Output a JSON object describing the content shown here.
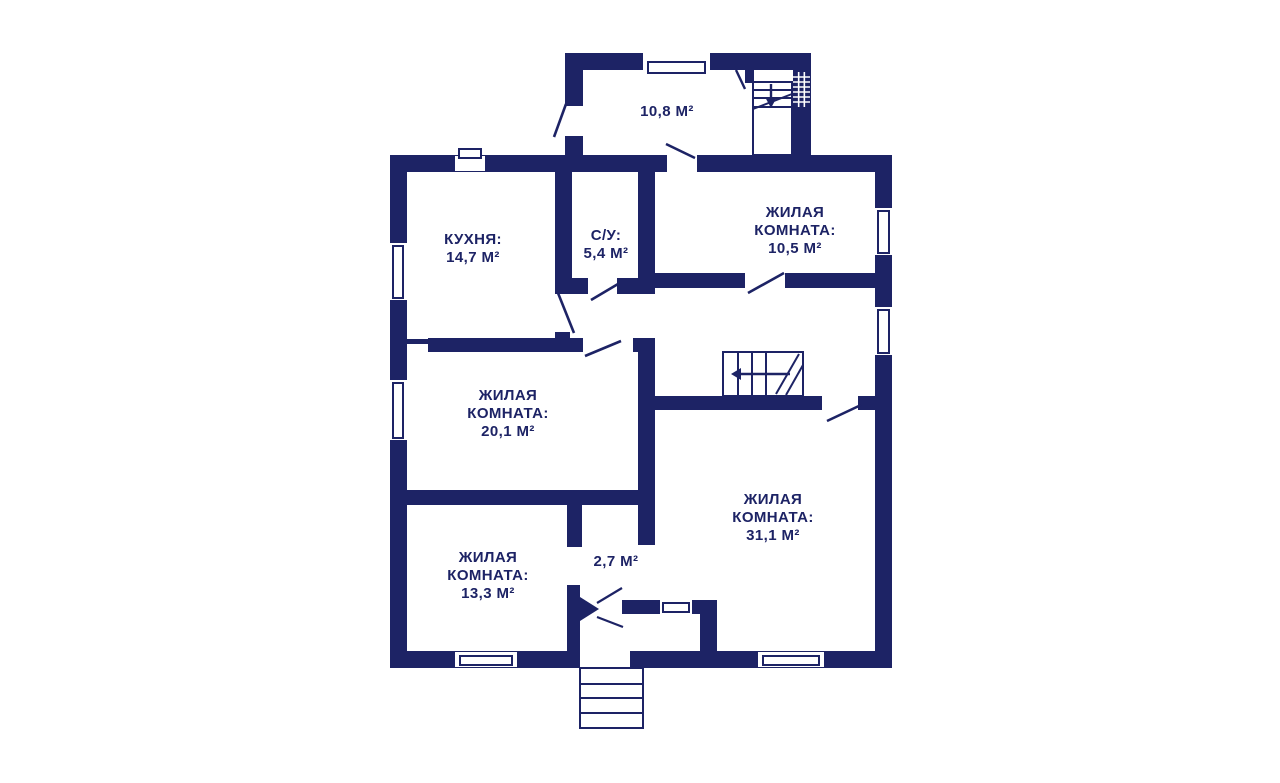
{
  "meta": {
    "type": "floor-plan",
    "wall_color": "#1d2365",
    "background_color": "#ffffff"
  },
  "labels": {
    "annex": {
      "l1": "10,8 М²"
    },
    "kitchen": {
      "l1": "КУХНЯ:",
      "l2": "14,7 М²"
    },
    "bathroom": {
      "l1": "С/У:",
      "l2": "5,4 М²"
    },
    "living_top": {
      "l1": "ЖИЛАЯ",
      "l2": "КОМНАТА:",
      "l3": "10,5 М²"
    },
    "living_mid": {
      "l1": "ЖИЛАЯ",
      "l2": "КОМНАТА:",
      "l3": "20,1 М²"
    },
    "living_big": {
      "l1": "ЖИЛАЯ",
      "l2": "КОМНАТА:",
      "l3": "31,1 М²"
    },
    "living_bottom": {
      "l1": "ЖИЛАЯ",
      "l2": "КОМНАТА:",
      "l3": "13,3 М²"
    },
    "hallway": {
      "l1": "2,7 М²"
    }
  },
  "geometry": {
    "walls": [
      [
        565,
        53,
        246,
        17
      ],
      [
        565,
        53,
        18,
        53
      ],
      [
        565,
        136,
        18,
        20
      ],
      [
        793,
        53,
        18,
        102
      ],
      [
        390,
        155,
        277,
        17
      ],
      [
        697,
        155,
        195,
        17
      ],
      [
        390,
        155,
        17,
        513
      ],
      [
        875,
        155,
        17,
        513
      ],
      [
        390,
        651,
        190,
        17
      ],
      [
        630,
        651,
        262,
        17
      ],
      [
        555,
        170,
        17,
        122
      ],
      [
        555,
        332,
        15,
        20
      ],
      [
        638,
        172,
        17,
        121
      ],
      [
        555,
        278,
        33,
        16
      ],
      [
        617,
        278,
        38,
        16
      ],
      [
        655,
        273,
        90,
        15
      ],
      [
        785,
        273,
        90,
        15
      ],
      [
        407,
        339,
        23,
        5
      ],
      [
        428,
        338,
        155,
        14
      ],
      [
        633,
        338,
        22,
        14
      ],
      [
        638,
        342,
        17,
        203
      ],
      [
        655,
        396,
        167,
        14
      ],
      [
        858,
        396,
        17,
        14
      ],
      [
        390,
        490,
        250,
        15
      ],
      [
        567,
        505,
        15,
        42
      ],
      [
        567,
        585,
        13,
        82
      ],
      [
        622,
        600,
        38,
        14
      ],
      [
        692,
        600,
        25,
        14
      ],
      [
        700,
        600,
        17,
        68
      ],
      [
        745,
        70,
        9,
        13
      ]
    ],
    "windows": [
      {
        "hole": [
          643,
          53,
          67,
          17
        ],
        "slab": [
          648,
          62,
          57,
          11
        ]
      },
      {
        "hole": [
          455,
          156,
          30,
          15
        ],
        "slab": [
          459,
          149,
          22,
          9
        ]
      },
      {
        "hole": [
          390,
          243,
          17,
          57
        ],
        "slab": [
          393,
          246,
          10,
          52
        ]
      },
      {
        "hole": [
          390,
          380,
          17,
          60
        ],
        "slab": [
          393,
          383,
          10,
          55
        ]
      },
      {
        "hole": [
          875,
          208,
          17,
          47
        ],
        "slab": [
          878,
          211,
          11,
          42
        ]
      },
      {
        "hole": [
          875,
          307,
          17,
          48
        ],
        "slab": [
          878,
          310,
          11,
          43
        ]
      },
      {
        "hole": [
          455,
          652,
          62,
          15
        ],
        "slab": [
          460,
          656,
          52,
          9
        ]
      },
      {
        "hole": [
          758,
          652,
          66,
          15
        ],
        "slab": [
          763,
          656,
          56,
          9
        ]
      },
      {
        "hole": [
          660,
          600,
          32,
          14
        ],
        "slab": [
          663,
          603,
          26,
          9
        ]
      }
    ],
    "stair_boxes": [
      [
        753,
        82,
        39,
        73
      ],
      [
        723,
        352,
        80,
        44
      ],
      [
        580,
        668,
        63,
        60
      ]
    ],
    "lines": [
      [
        753,
        90,
        792,
        90,
        2
      ],
      [
        753,
        98,
        792,
        98,
        2
      ],
      [
        753,
        107,
        792,
        107,
        2
      ],
      [
        753,
        109,
        792,
        94,
        2
      ],
      [
        771,
        84,
        771,
        100,
        2.4
      ],
      [
        736,
        70,
        745,
        89,
        2.4
      ],
      [
        738,
        352,
        738,
        396,
        2
      ],
      [
        752,
        352,
        752,
        396,
        2
      ],
      [
        766,
        352,
        766,
        396,
        2
      ],
      [
        776,
        394,
        799,
        354,
        2
      ],
      [
        786,
        395,
        803,
        365,
        2
      ],
      [
        790,
        374,
        740,
        374,
        2.4
      ],
      [
        666,
        144,
        695,
        158,
        2.6
      ],
      [
        748,
        293,
        784,
        273,
        2.6
      ],
      [
        585,
        356,
        621,
        341,
        2.6
      ],
      [
        827,
        421,
        861,
        405,
        2.6
      ],
      [
        558,
        293,
        574,
        333,
        2.6
      ],
      [
        566,
        104,
        554,
        137,
        2.6
      ],
      [
        591,
        300,
        618,
        284,
        2.6
      ],
      [
        597,
        603,
        622,
        588,
        2.2
      ],
      [
        597,
        617,
        623,
        627,
        2.2
      ],
      [
        580,
        684,
        643,
        684,
        2
      ],
      [
        580,
        698,
        643,
        698,
        2
      ],
      [
        580,
        713,
        643,
        713,
        2
      ]
    ],
    "polys": [
      [
        [
          771,
          108
        ],
        [
          765,
          97
        ],
        [
          777,
          97
        ]
      ],
      [
        [
          731,
          374
        ],
        [
          741,
          368
        ],
        [
          741,
          380
        ]
      ],
      [
        [
          580,
          597
        ],
        [
          599,
          609
        ],
        [
          580,
          621
        ]
      ]
    ],
    "ladder": {
      "x": 793,
      "y": 72,
      "w": 17,
      "h": 35,
      "cols": 3,
      "row_step": 5
    }
  }
}
